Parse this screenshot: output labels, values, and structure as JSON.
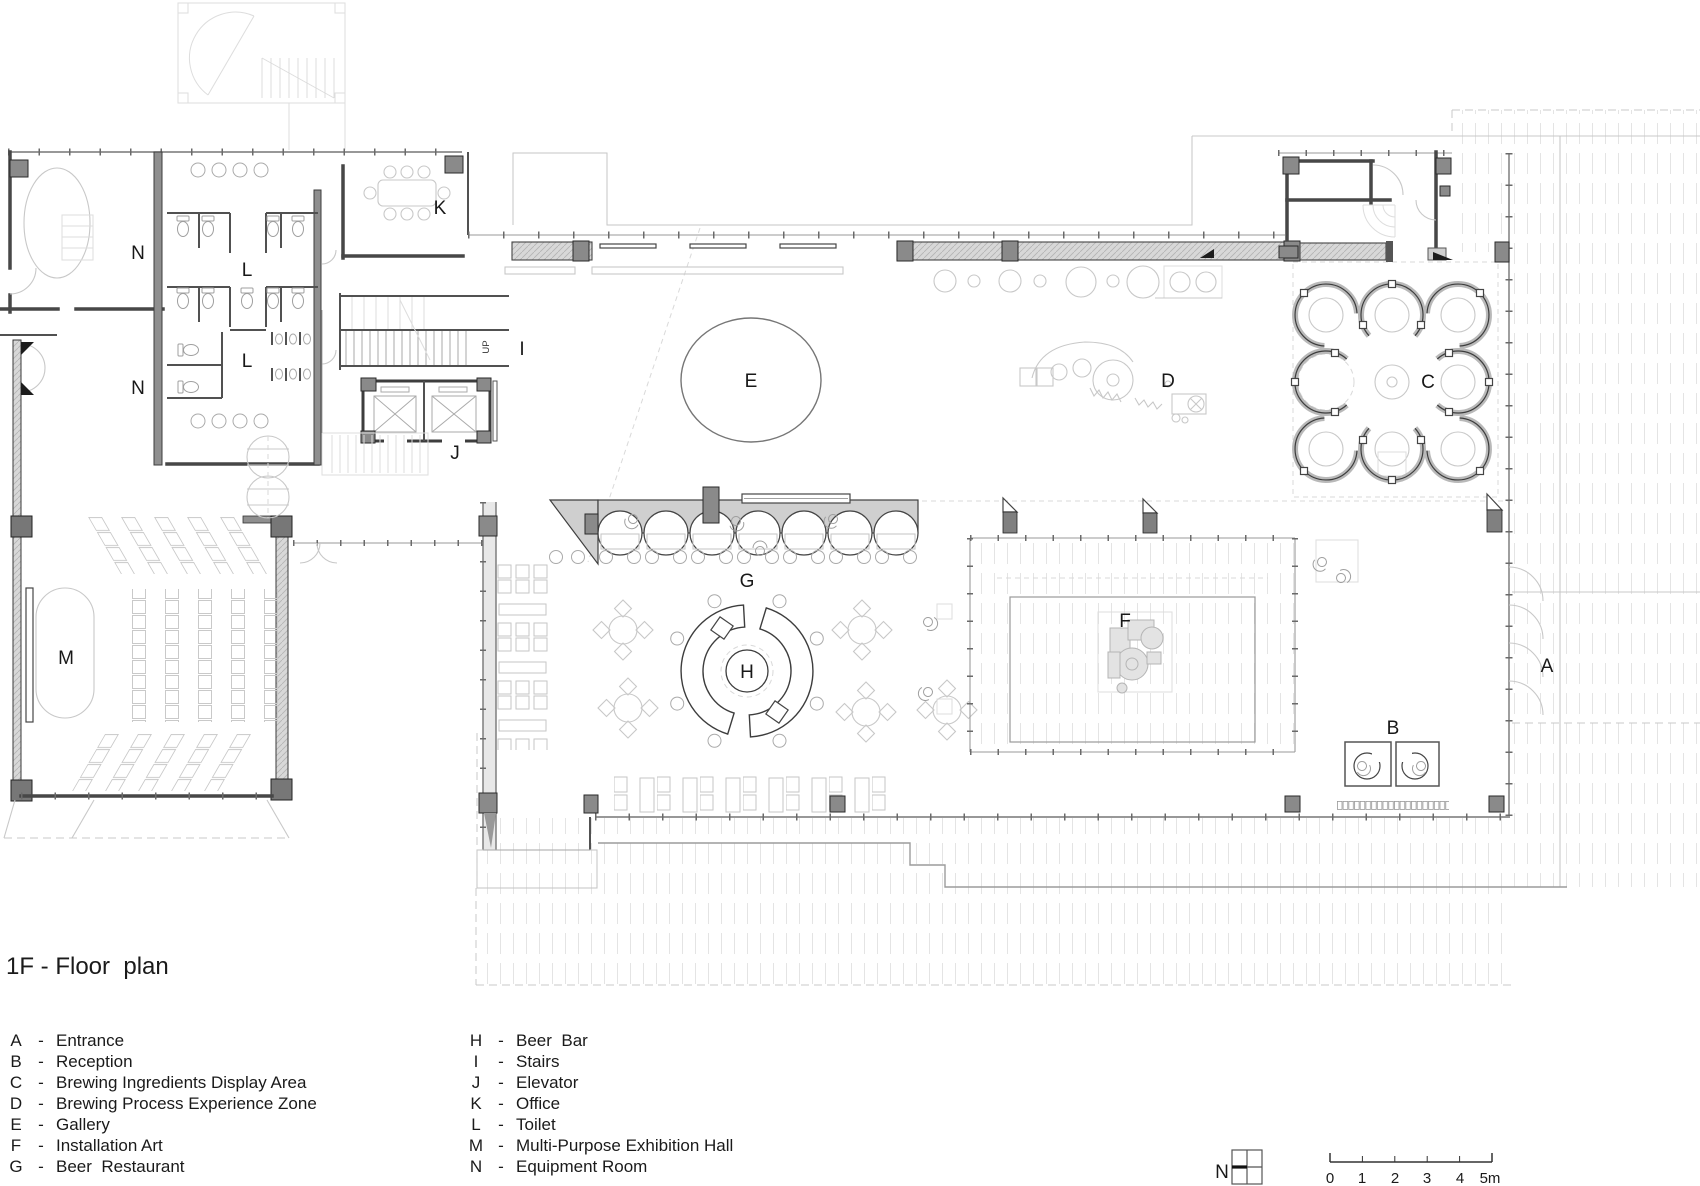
{
  "title": "1F - Floor  plan",
  "legend": {
    "dash": "-",
    "left": [
      {
        "key": "A",
        "label": "Entrance"
      },
      {
        "key": "B",
        "label": "Reception"
      },
      {
        "key": "C",
        "label": "Brewing Ingredients Display Area"
      },
      {
        "key": "D",
        "label": "Brewing Process Experience Zone"
      },
      {
        "key": "E",
        "label": "Gallery"
      },
      {
        "key": "F",
        "label": "Installation Art"
      },
      {
        "key": "G",
        "label": "Beer  Restaurant"
      }
    ],
    "right": [
      {
        "key": "H",
        "label": "Beer  Bar"
      },
      {
        "key": "I",
        "label": "Stairs"
      },
      {
        "key": "J",
        "label": "Elevator"
      },
      {
        "key": "K",
        "label": "Office"
      },
      {
        "key": "L",
        "label": "Toilet"
      },
      {
        "key": "M",
        "label": "Multi-Purpose Exhibition Hall"
      },
      {
        "key": "N",
        "label": "Equipment Room"
      }
    ]
  },
  "plan": {
    "rooms": {
      "a": "A",
      "b": "B",
      "c": "C",
      "d": "D",
      "e": "E",
      "f": "F",
      "g": "G",
      "h": "H",
      "i": "I",
      "j": "J",
      "k": "K",
      "l": "L",
      "m": "M",
      "n": "N",
      "up": "UP"
    }
  },
  "north": {
    "label": "N"
  },
  "scale_bar": {
    "ticks": [
      "0",
      "1",
      "2",
      "3",
      "4",
      "5m"
    ]
  },
  "colors": {
    "wall": "#474747",
    "fill_light": "#d8d8d8",
    "paving": "#e3e3e3",
    "background": "#ffffff"
  }
}
